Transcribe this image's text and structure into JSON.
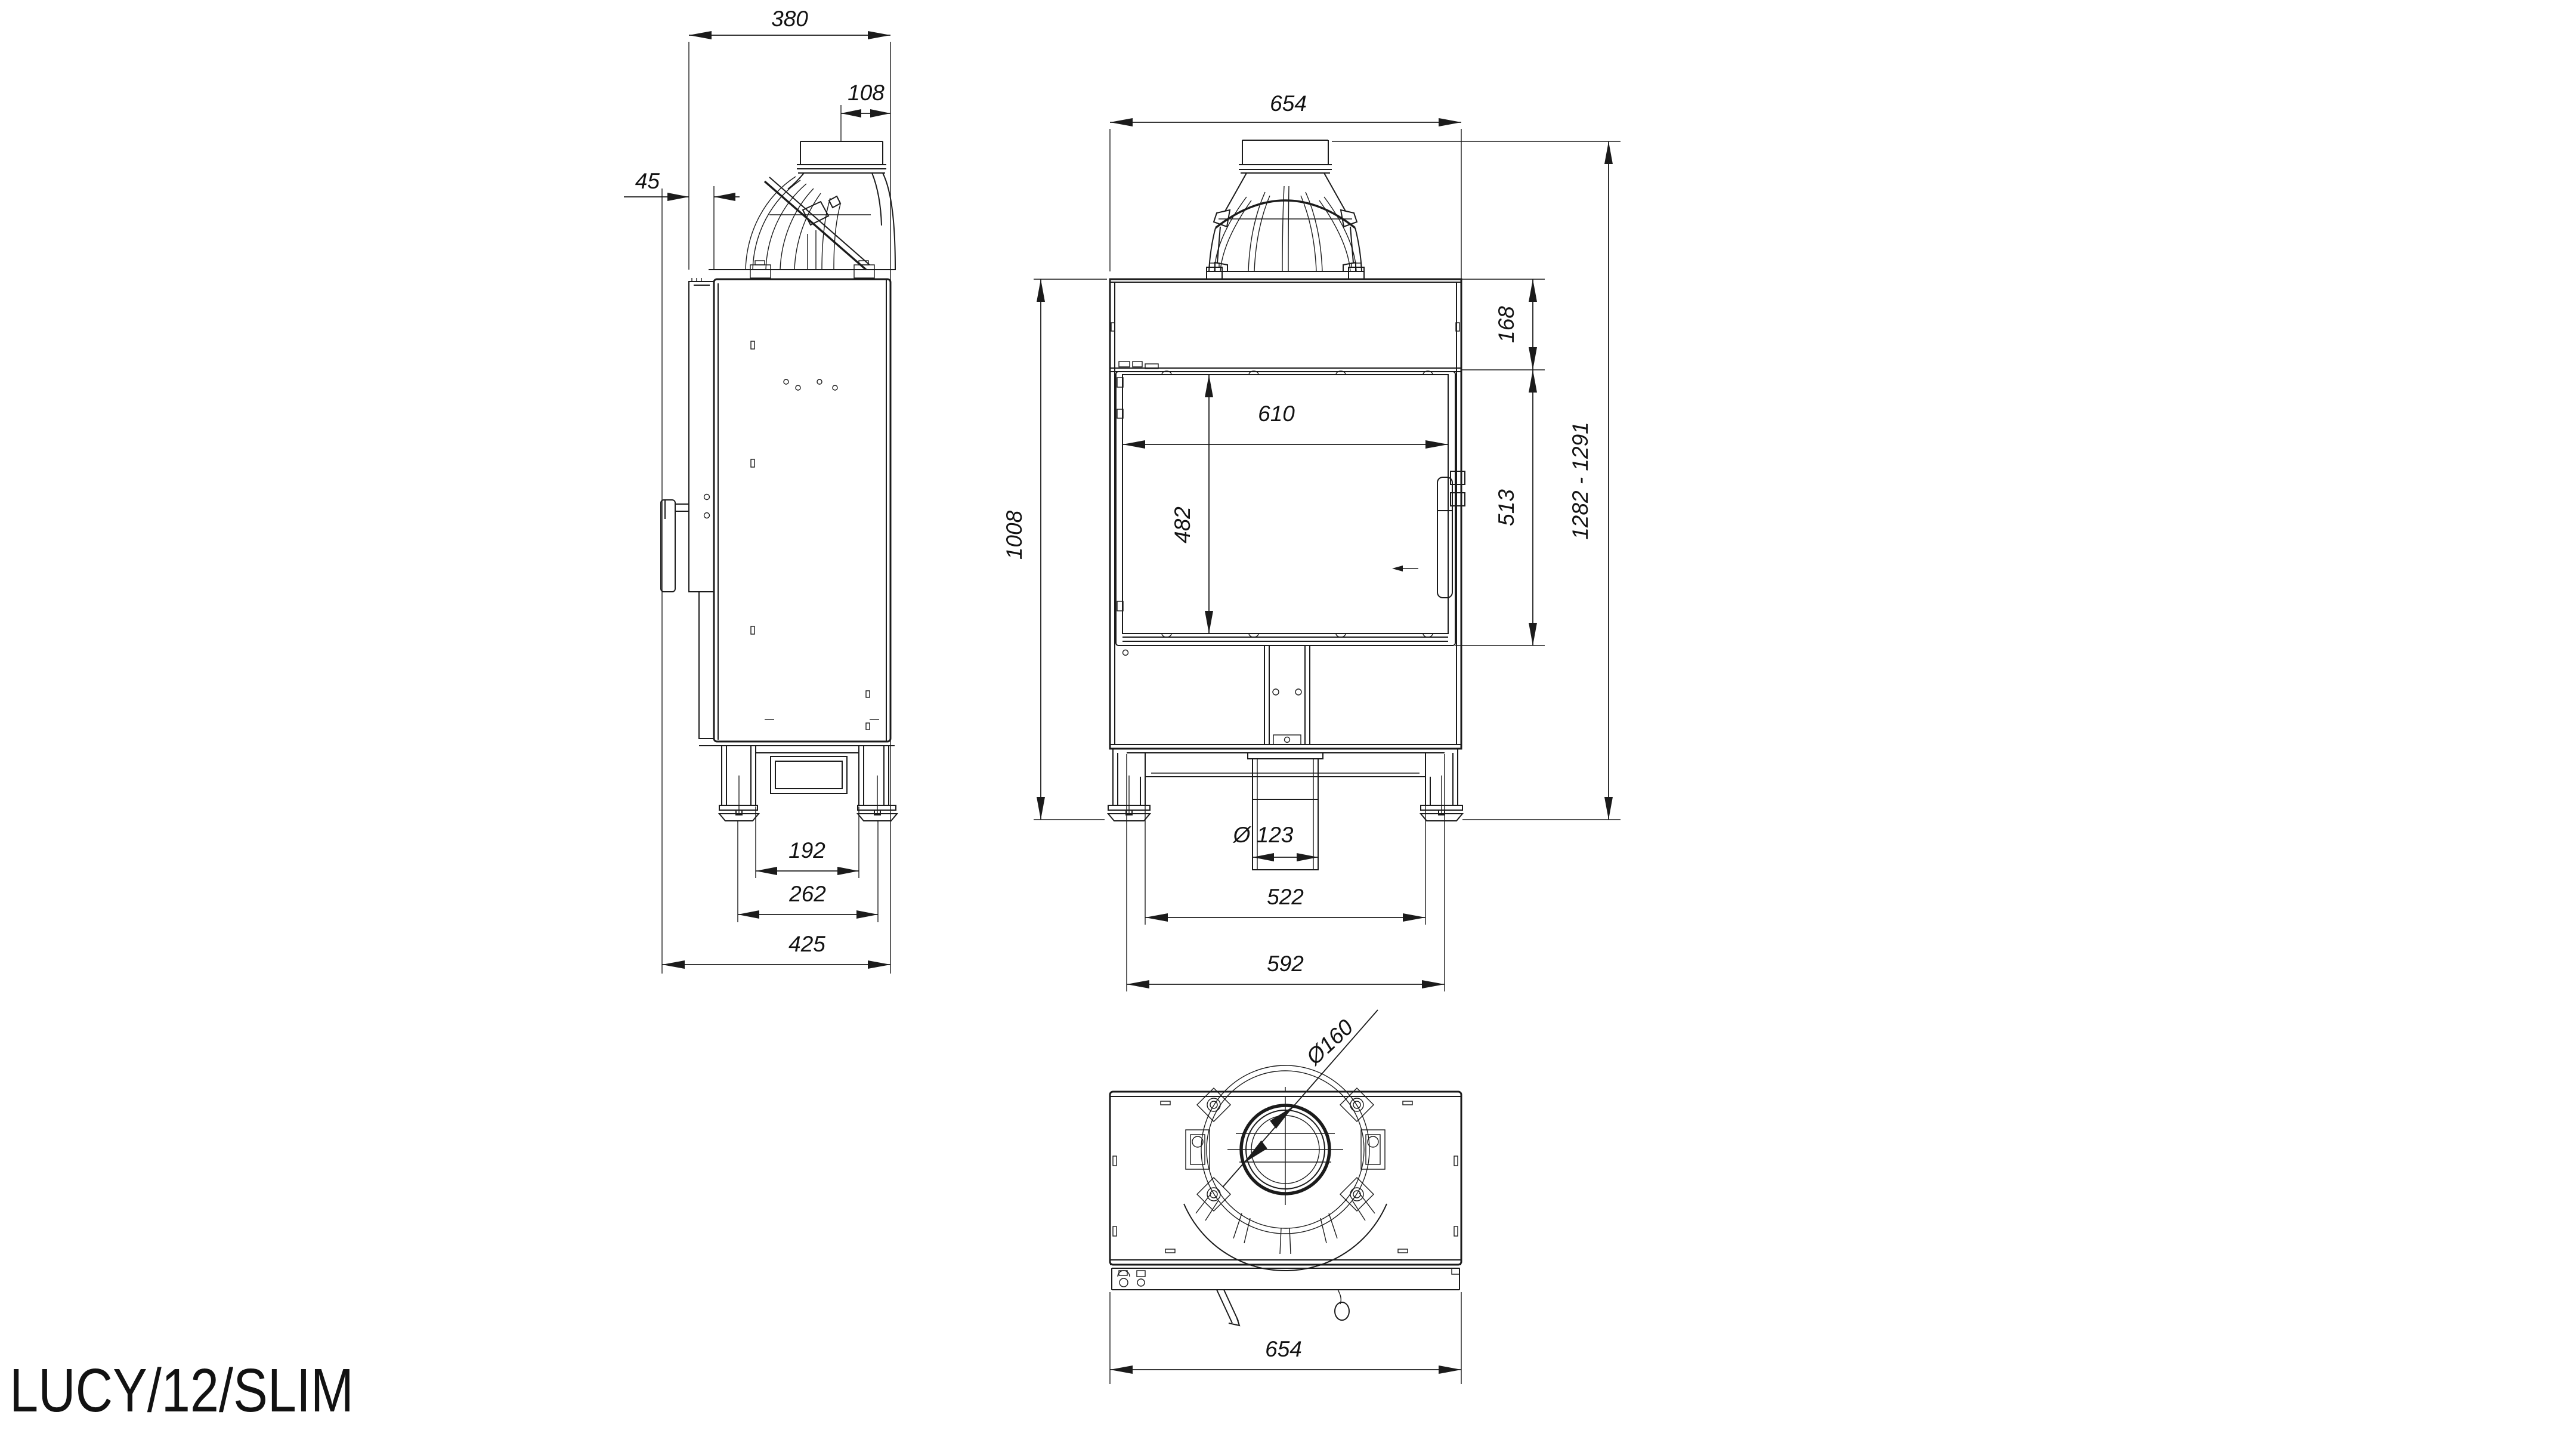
{
  "drawing": {
    "title": "LUCY/12/SLIM",
    "side_view": {
      "body_depth": "380",
      "flue_axis_to_rear": "108",
      "door_protrusion": "45",
      "feet_inner_gap": "192",
      "feet_centers": "262",
      "overall_depth": "425"
    },
    "front_view": {
      "overall_width": "654",
      "top_band_height": "168",
      "glass_width": "610",
      "glass_height": "482",
      "body_height": "1008",
      "door_frame_height": "513",
      "overall_height_range": "1282 - 1291",
      "air_intake_diameter": "Ø 123",
      "plinth_width": "522",
      "skirt_width": "592"
    },
    "top_view": {
      "flue_diameter": "Ø160",
      "overall_width": "654"
    }
  }
}
